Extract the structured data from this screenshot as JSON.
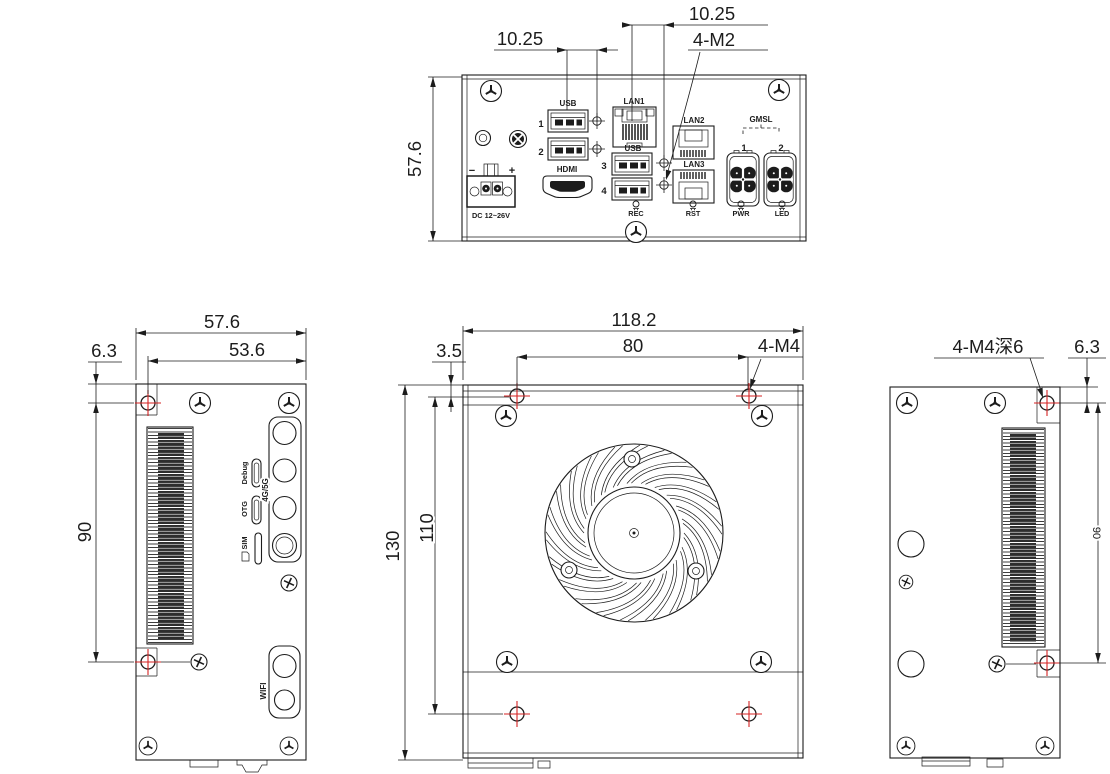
{
  "colors": {
    "line": "#1c1c1c",
    "marker": "#d42222",
    "background": "#ffffff"
  },
  "front_view": {
    "dims": {
      "height": "57.6",
      "offset_left": "10.25",
      "offset_right": "10.25",
      "thread_note": "4-M2"
    },
    "labels": {
      "usb_group_top": "USB",
      "usb_group_mid": "USB",
      "port1": "1",
      "port2": "2",
      "port3": "3",
      "port4": "4",
      "lan1": "LAN1",
      "lan2": "LAN2",
      "lan3": "LAN3",
      "hdmi": "HDMI",
      "dc_minus": "−",
      "dc_plus": "+",
      "dc_rating": "DC 12~26V",
      "gmsl": "GMSL",
      "gmsl_1": "1",
      "gmsl_2": "2",
      "rec": "REC",
      "rst": "RST",
      "pwr": "PWR",
      "led": "LED"
    }
  },
  "left_view": {
    "dims": {
      "width": "57.6",
      "hole_to_edge": "53.6",
      "edge_offset": "6.3",
      "hole_span": "90"
    },
    "labels": {
      "debug": "Debug",
      "otg": "OTG",
      "sim": "SIM",
      "cellular": "4G/5G",
      "wifi": "WIFI"
    }
  },
  "top_view": {
    "dims": {
      "width": "118.2",
      "hole_span": "80",
      "thread_note": "4-M4",
      "edge_offset": "3.5",
      "depth": "130",
      "hole_depth_span": "110"
    }
  },
  "right_view": {
    "dims": {
      "thread_note": "4-M4深6",
      "edge_offset": "6.3",
      "hole_span": "90"
    }
  }
}
